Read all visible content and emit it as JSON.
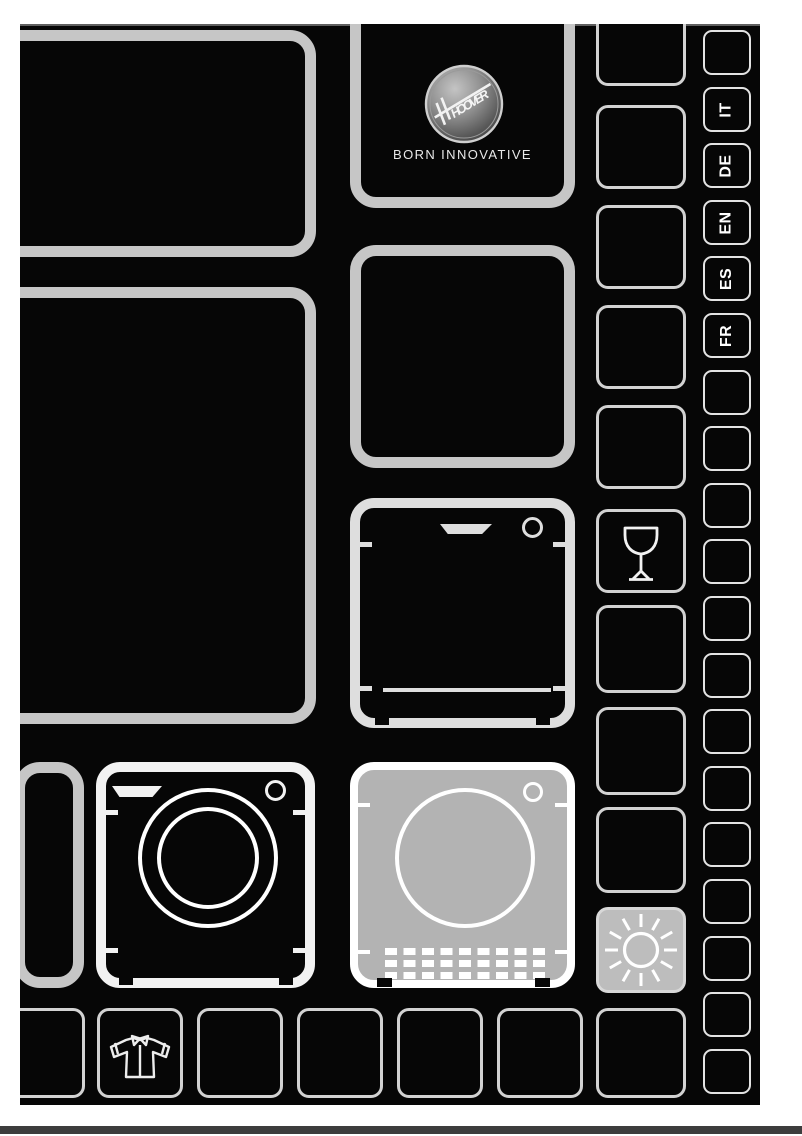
{
  "page": {
    "title": "Hoover appliance user manual cover",
    "brand": {
      "logo_wordmark": "HOOVER",
      "tagline": "BORN INNOVATIVE"
    },
    "languages": [
      "IT",
      "DE",
      "EN",
      "ES",
      "FR"
    ],
    "icons": {
      "hoover_logo": "hoover-logo",
      "dishwasher": "dishwasher-icon",
      "washing_machine": "washing-machine-icon",
      "tumble_dryer": "tumble-dryer-icon",
      "wine_glass": "wine-glass-icon",
      "sun": "sun-icon",
      "shirt": "shirt-icon"
    },
    "highlighted_tiles": [
      "tumble-dryer-tile",
      "sun-tile"
    ],
    "colors": {
      "page_margin": "#ffffff",
      "cover_background": "#060606",
      "tile_border_gray": "#c6c6c6",
      "tile_border_white": "#f2f2f2",
      "highlight_fill": "#b3b3b3",
      "label_text": "#ffffff",
      "footer_bar": "#3d3d3d"
    }
  }
}
